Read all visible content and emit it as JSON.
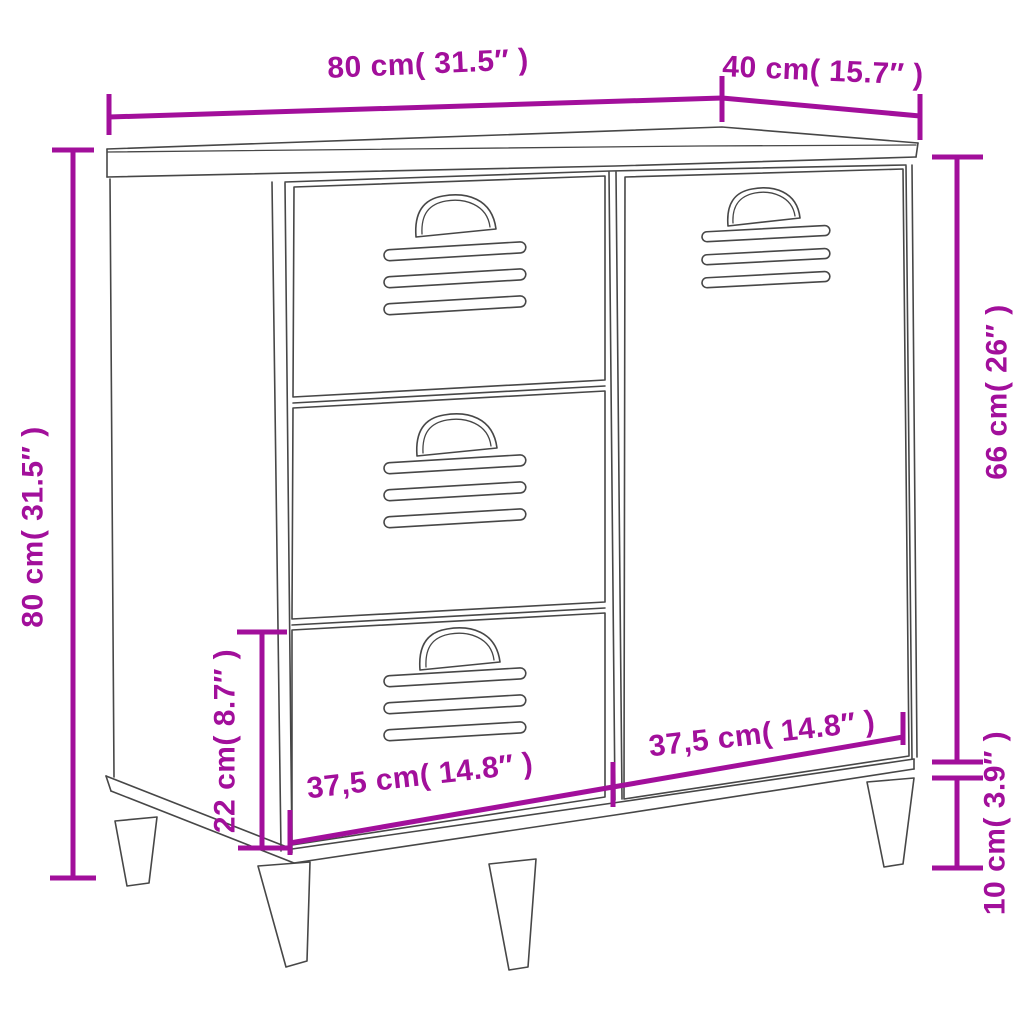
{
  "diagram": {
    "subject": "sideboard with three drawers and one door",
    "labels": {
      "top_width": "80 cm( 31.5″ )",
      "top_depth": "40 cm( 15.7″ )",
      "overall_height": "80 cm( 31.5″ )",
      "right_upper_height": "66 cm( 26″ )",
      "left_lower_height": "22 cm( 8.7″ )",
      "leg_height": "10 cm( 3.9″ )",
      "bottom_left_width": "37,5 cm( 14.8″ )",
      "bottom_right_width": "37,5 cm( 14.8″ )"
    },
    "colors": {
      "dimension": "#A20F9B",
      "outline": "#474747",
      "background": "#FFFFFF"
    }
  }
}
